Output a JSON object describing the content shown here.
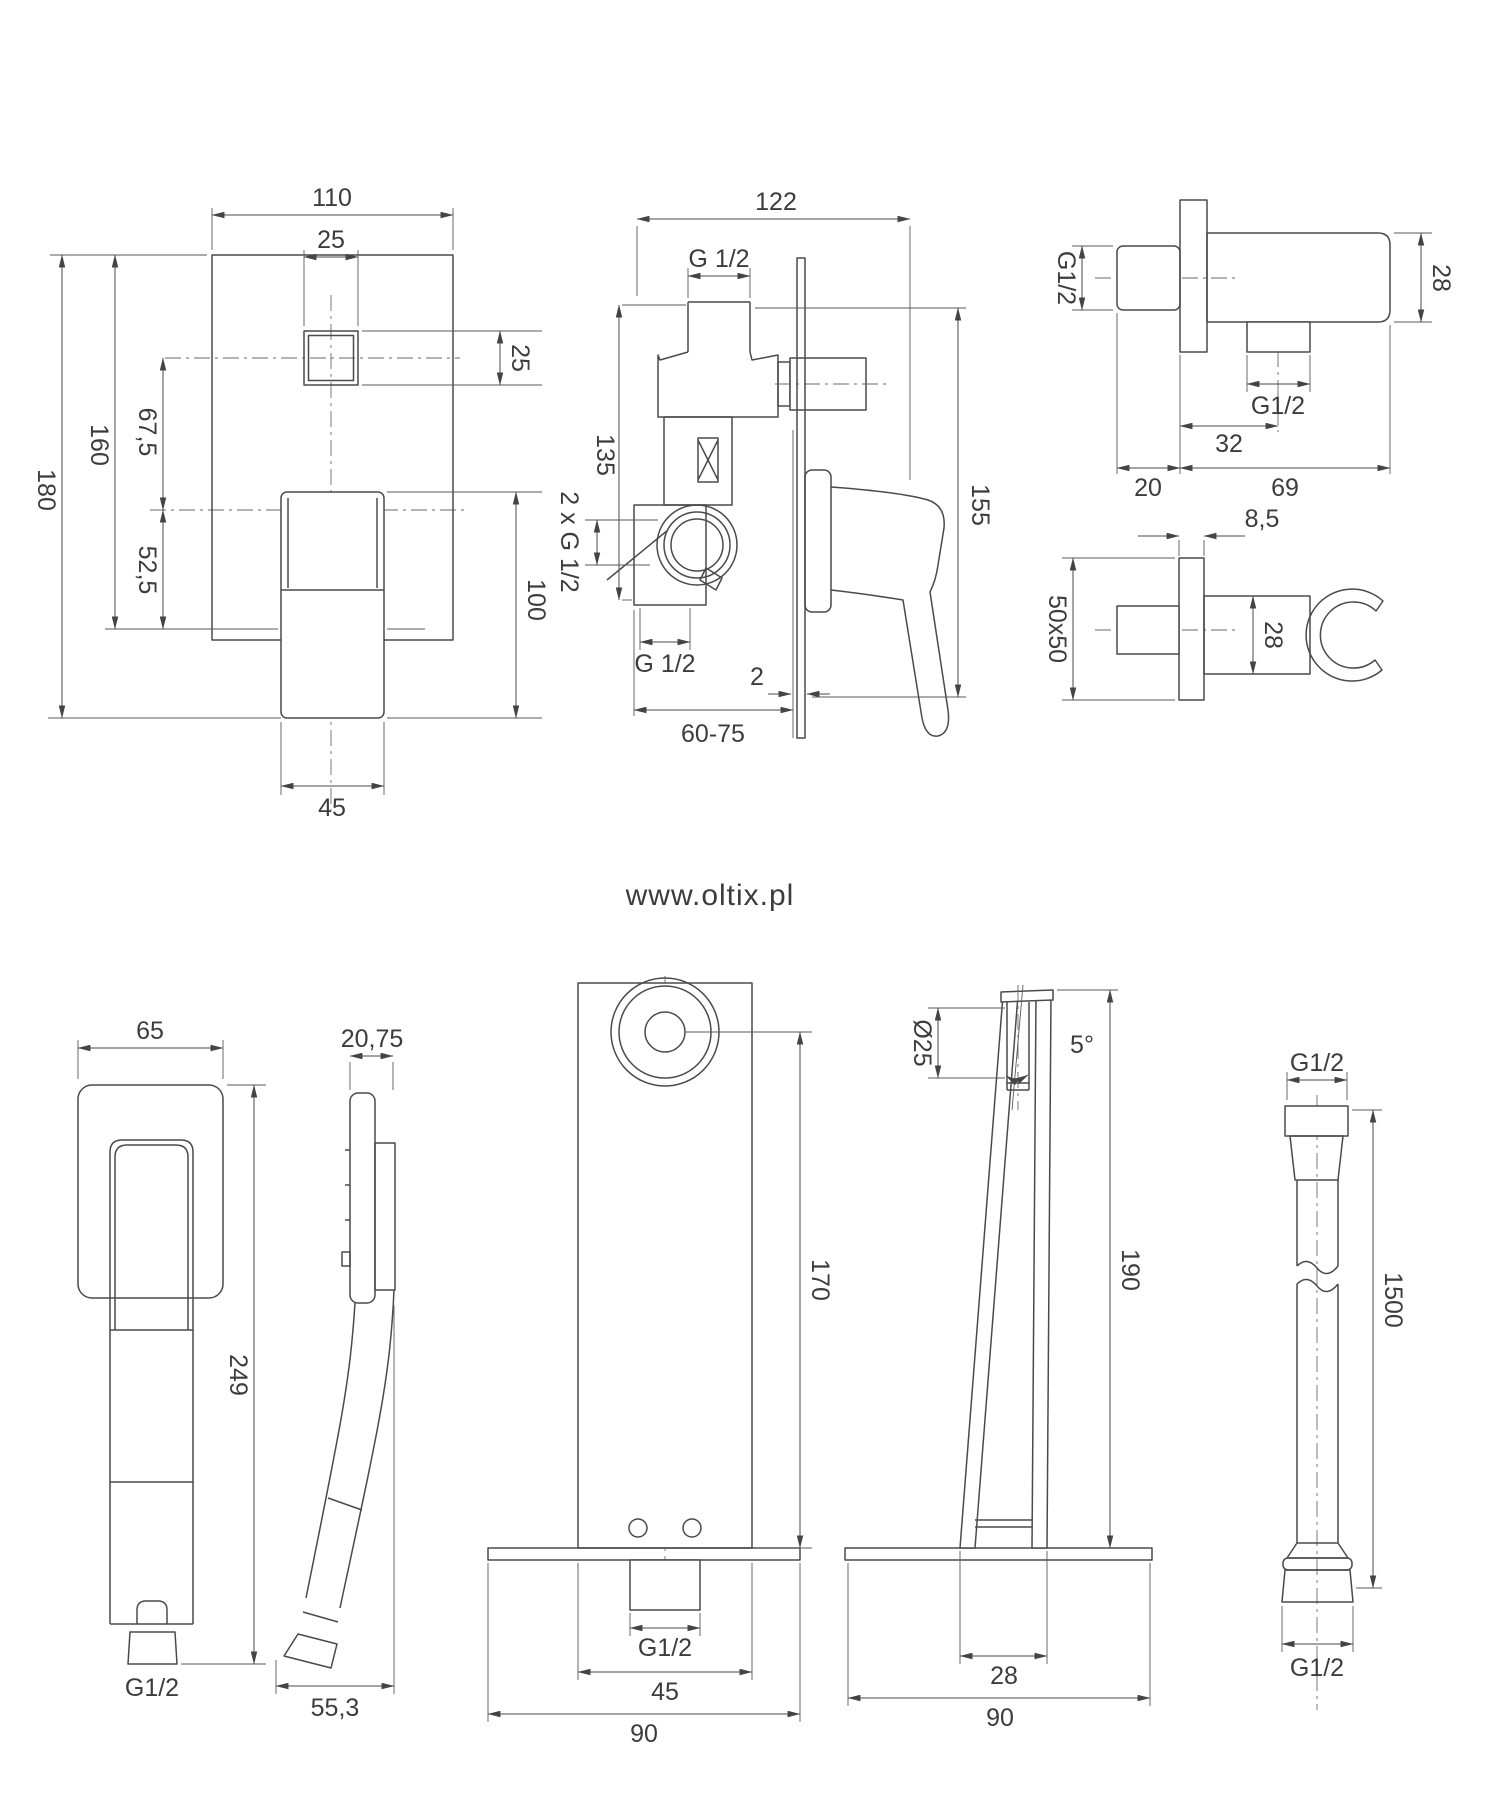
{
  "watermark": "www.oltix.pl",
  "colors": {
    "line": "#4a4a4a",
    "text": "#3c3c3c",
    "watermark": "#e4e4e4"
  },
  "views": {
    "mixer_front": {
      "d_width": "110",
      "d_knob": "25",
      "d_knob_side": "25",
      "d_height_total": "180",
      "d_height_plate": "160",
      "d_knob_offset": "67,5",
      "d_center_offset": "52,5",
      "d_handle_height": "100",
      "d_handle_width": "45"
    },
    "mixer_side": {
      "d_depth": "122",
      "d_inlet_thread": "G 1/2",
      "d_body_height": "135",
      "d_ports": "2 x G 1/2",
      "d_outlet_thread": "G 1/2",
      "d_wall_gap": "2",
      "d_mount_depth": "60-75",
      "d_total_height": "155"
    },
    "elbow": {
      "d_thread_in": "G1/2",
      "d_body_height": "28",
      "d_thread_out": "G1/2",
      "d_outlet_offset": "32",
      "d_stub_length": "20",
      "d_body_length": "69"
    },
    "holder": {
      "d_plate_thickness": "8,5",
      "d_plate": "50x50",
      "d_holder_height": "28"
    },
    "hand_shower": {
      "d_head_width": "65",
      "d_head_depth": "20,75",
      "d_length": "249",
      "d_thread": "G1/2",
      "d_depth_total": "55,3"
    },
    "spout_front": {
      "d_outlet_height": "170",
      "d_thread": "G1/2",
      "d_body_width": "45",
      "d_plate_width": "90"
    },
    "spout_side": {
      "d_outlet_diameter": "Ø25",
      "d_angle": "5°",
      "d_height": "190",
      "d_base_width": "28",
      "d_plate_width": "90"
    },
    "hose": {
      "d_thread_top": "G1/2",
      "d_length": "1500",
      "d_thread_bottom": "G1/2"
    }
  }
}
